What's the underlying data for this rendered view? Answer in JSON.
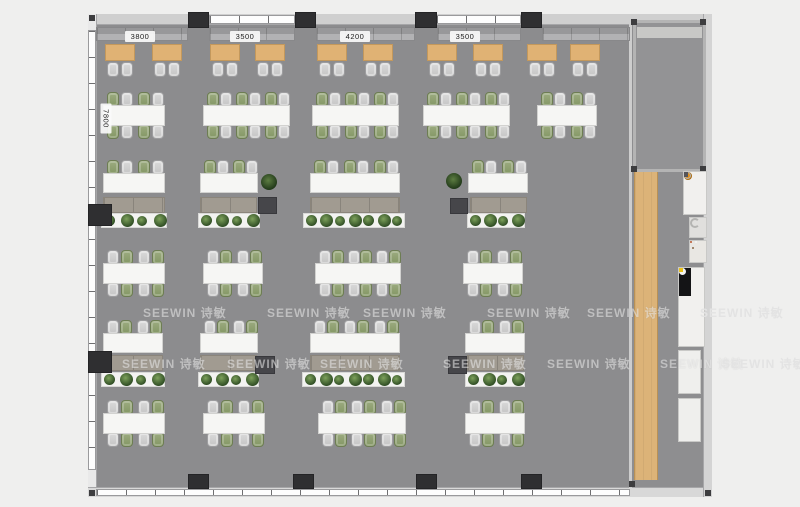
{
  "watermark": {
    "text": "SEEWIN 诗敏",
    "rows": [
      {
        "y": 306,
        "xs": [
          143,
          267,
          363,
          487,
          587,
          700
        ]
      },
      {
        "y": 357,
        "xs": [
          122,
          227,
          320,
          443,
          547,
          660,
          722
        ]
      }
    ]
  },
  "dimensions": {
    "top": [
      {
        "label": "3800",
        "cx": 140
      },
      {
        "label": "3500",
        "cx": 245
      },
      {
        "label": "4200",
        "cx": 355
      },
      {
        "label": "3500",
        "cx": 465
      }
    ],
    "side": {
      "label": "7800",
      "cx": 106,
      "cy": 119
    }
  },
  "colors": {
    "outside": "#efefee",
    "floor": "#8c8c8e",
    "wood_strip": "#dcb378",
    "booth_table": "#e0b274",
    "chair_gray": "#cccccc",
    "chair_green": "#8a9a6b",
    "desk": "#f6f6f4",
    "cabinet": "#a19b91",
    "plant": "#2f4d24",
    "pillar": "#2f2f31",
    "accent_orange": "#e2901d"
  },
  "floorplan": {
    "booths": {
      "bench_y": 27,
      "bench_h": 14,
      "bench_segments": [
        [
          96,
          188
        ],
        [
          209,
          295
        ],
        [
          316,
          415
        ],
        [
          437,
          521
        ],
        [
          542,
          630
        ]
      ],
      "table_y": 44,
      "table_w": 30,
      "table_h": 17,
      "chair_y": 62,
      "table_xs": [
        105,
        152,
        210,
        255,
        317,
        363,
        427,
        473,
        527,
        570
      ]
    },
    "desk_rows": [
      {
        "y": 105,
        "h": 21,
        "chairs": "both",
        "start": "green",
        "units": [
          [
            103,
            62,
            2
          ],
          [
            203,
            87,
            3
          ],
          [
            312,
            87,
            3
          ],
          [
            423,
            87,
            3
          ],
          [
            537,
            60,
            2
          ]
        ]
      },
      {
        "y": 173,
        "h": 20,
        "chairs": "top",
        "start": "green",
        "cab_y": 197,
        "cab_h": 16,
        "planter_y": 213,
        "planter_h": 15,
        "units": [
          [
            103,
            62,
            2
          ],
          [
            200,
            58,
            2
          ],
          [
            310,
            90,
            3
          ],
          [
            468,
            60,
            2
          ]
        ],
        "cabinets": [
          [
            103,
            62
          ],
          [
            200,
            57
          ],
          [
            310,
            90
          ],
          [
            470,
            57
          ]
        ],
        "planters": [
          [
            101,
            66,
            4
          ],
          [
            198,
            62,
            4
          ],
          [
            303,
            102,
            7
          ],
          [
            467,
            58,
            4
          ]
        ]
      },
      {
        "y": 263,
        "h": 21,
        "chairs": "both",
        "start": "gray",
        "units": [
          [
            103,
            62,
            2
          ],
          [
            203,
            60,
            2
          ],
          [
            315,
            86,
            3
          ],
          [
            463,
            60,
            2
          ]
        ]
      },
      {
        "y": 333,
        "h": 20,
        "chairs": "top",
        "start": "gray",
        "cab_y": 355,
        "cab_h": 16,
        "planter_y": 372,
        "planter_h": 15,
        "units": [
          [
            103,
            60,
            2
          ],
          [
            200,
            58,
            2
          ],
          [
            310,
            90,
            3
          ],
          [
            465,
            60,
            2
          ]
        ],
        "cabinets": [
          [
            103,
            60
          ],
          [
            200,
            57
          ],
          [
            310,
            90
          ],
          [
            467,
            57
          ]
        ],
        "planters": [
          [
            101,
            64,
            4
          ],
          [
            198,
            61,
            4
          ],
          [
            302,
            103,
            7
          ],
          [
            465,
            60,
            4
          ]
        ]
      },
      {
        "y": 413,
        "h": 21,
        "chairs": "both",
        "start": "gray",
        "units": [
          [
            103,
            62,
            2
          ],
          [
            203,
            62,
            2
          ],
          [
            318,
            88,
            3
          ],
          [
            465,
            60,
            2
          ]
        ]
      }
    ],
    "pillars": [
      [
        188,
        12,
        21,
        16
      ],
      [
        295,
        12,
        21,
        16
      ],
      [
        415,
        12,
        22,
        16
      ],
      [
        521,
        12,
        21,
        16
      ],
      [
        188,
        474,
        21,
        15
      ],
      [
        293,
        474,
        21,
        15
      ],
      [
        416,
        474,
        21,
        15
      ],
      [
        521,
        474,
        21,
        15
      ],
      [
        88,
        204,
        24,
        22
      ],
      [
        88,
        351,
        24,
        22
      ]
    ],
    "boxes": [
      [
        258,
        197,
        19,
        17
      ],
      [
        450,
        198,
        18,
        16
      ],
      [
        255,
        356,
        20,
        18
      ],
      [
        448,
        356,
        19,
        18
      ]
    ],
    "deco_plants": [
      [
        261,
        174,
        16
      ],
      [
        446,
        173,
        16
      ]
    ],
    "wood_strip": {
      "x": 634,
      "y": 172,
      "w": 24,
      "h": 308
    },
    "fixtures": [
      {
        "type": "dispenser",
        "x": 683,
        "y": 171,
        "w": 24,
        "h": 44
      },
      {
        "type": "sink",
        "x": 689,
        "y": 217,
        "w": 18,
        "h": 21
      },
      {
        "type": "appliance",
        "x": 689,
        "y": 240,
        "w": 18,
        "h": 23
      },
      {
        "type": "counter",
        "x": 678,
        "y": 267,
        "w": 27,
        "h": 80
      },
      {
        "type": "cabinet",
        "x": 678,
        "y": 350,
        "w": 23,
        "h": 44
      },
      {
        "type": "cabinet",
        "x": 678,
        "y": 398,
        "w": 23,
        "h": 44
      }
    ]
  }
}
